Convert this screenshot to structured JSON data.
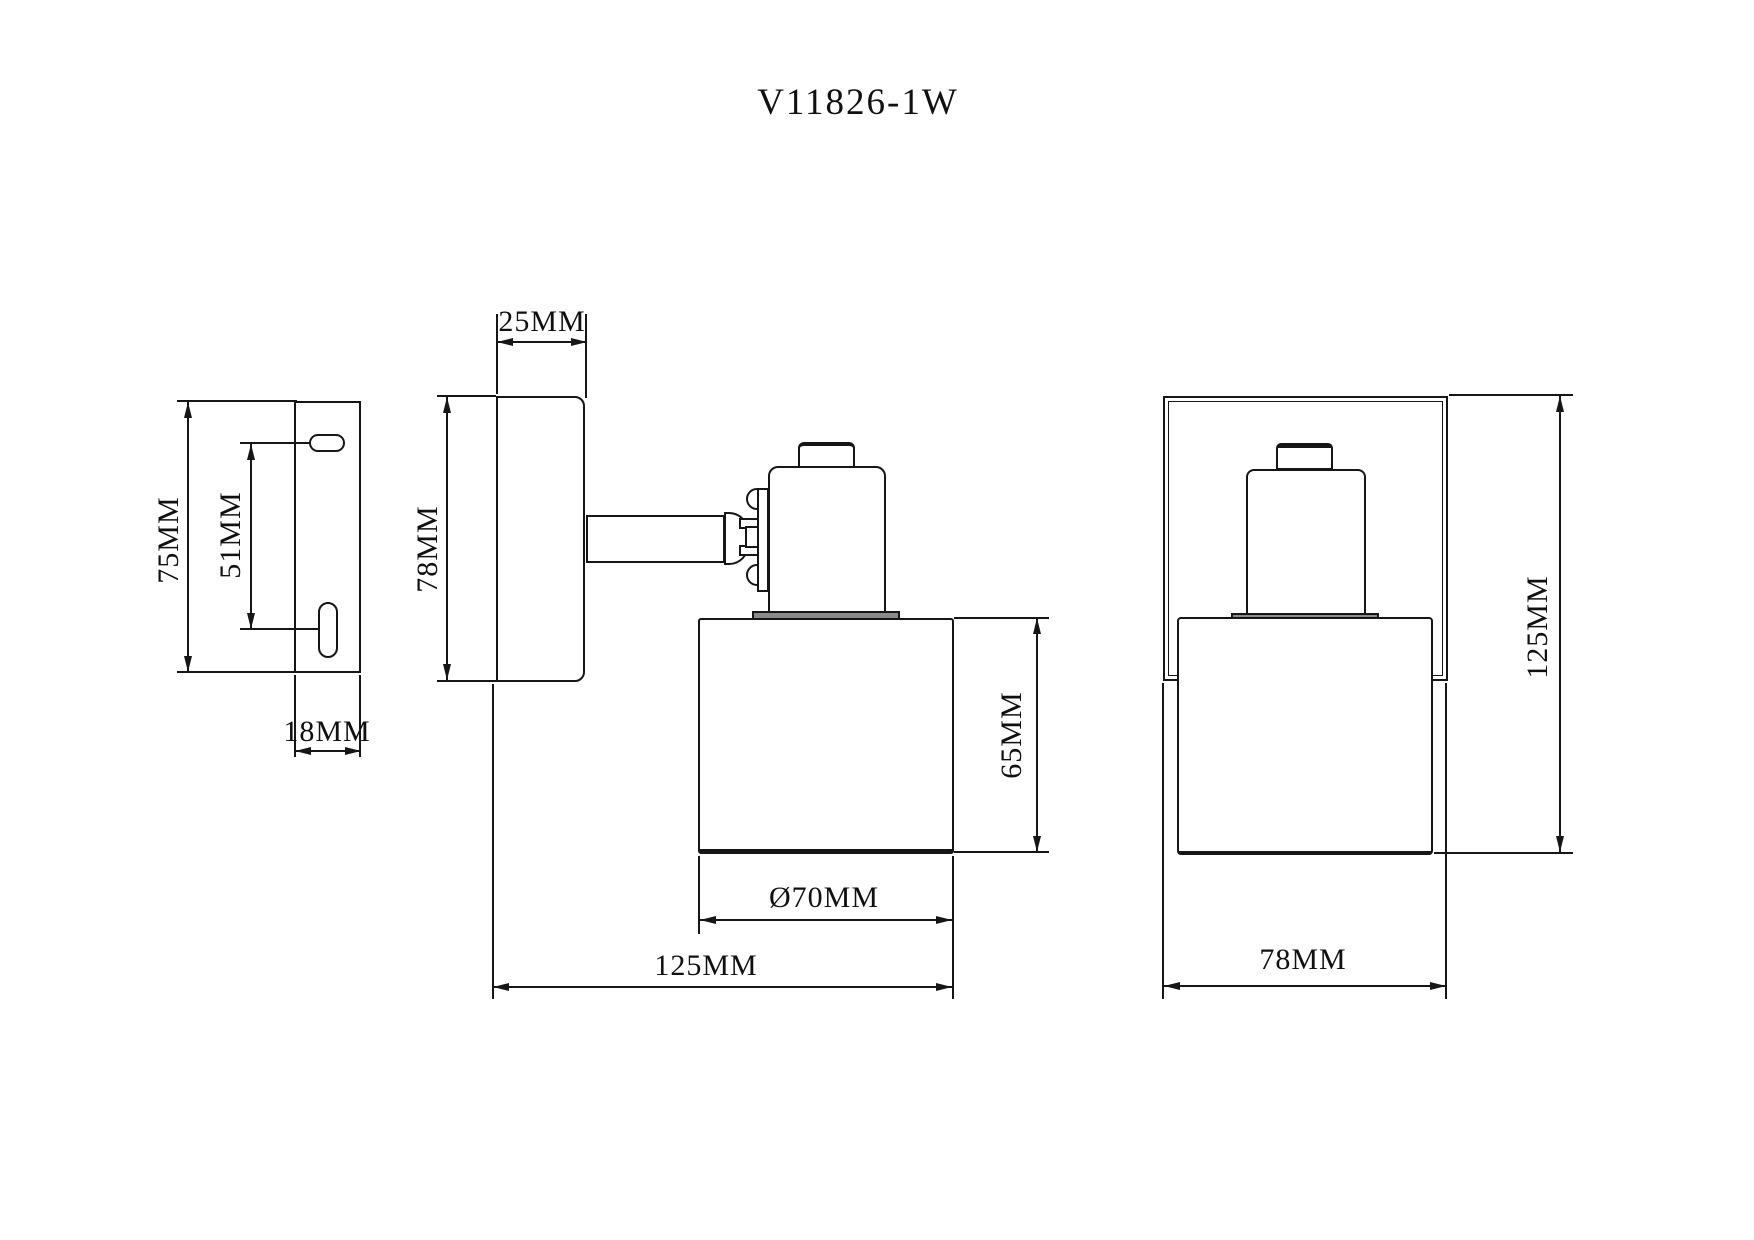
{
  "title": "V11826-1W",
  "views": {
    "bracket_side": {
      "dims": {
        "height": "75MM",
        "slot_spacing": "51MM",
        "depth": "18MM"
      }
    },
    "lamp_side": {
      "dims": {
        "canopy_depth": "25MM",
        "canopy_height": "78MM",
        "shade_height": "65MM",
        "shade_diameter": "Ø70MM",
        "overall_depth": "125MM"
      }
    },
    "lamp_front": {
      "dims": {
        "overall_height": "125MM",
        "canopy_width": "78MM"
      }
    }
  }
}
